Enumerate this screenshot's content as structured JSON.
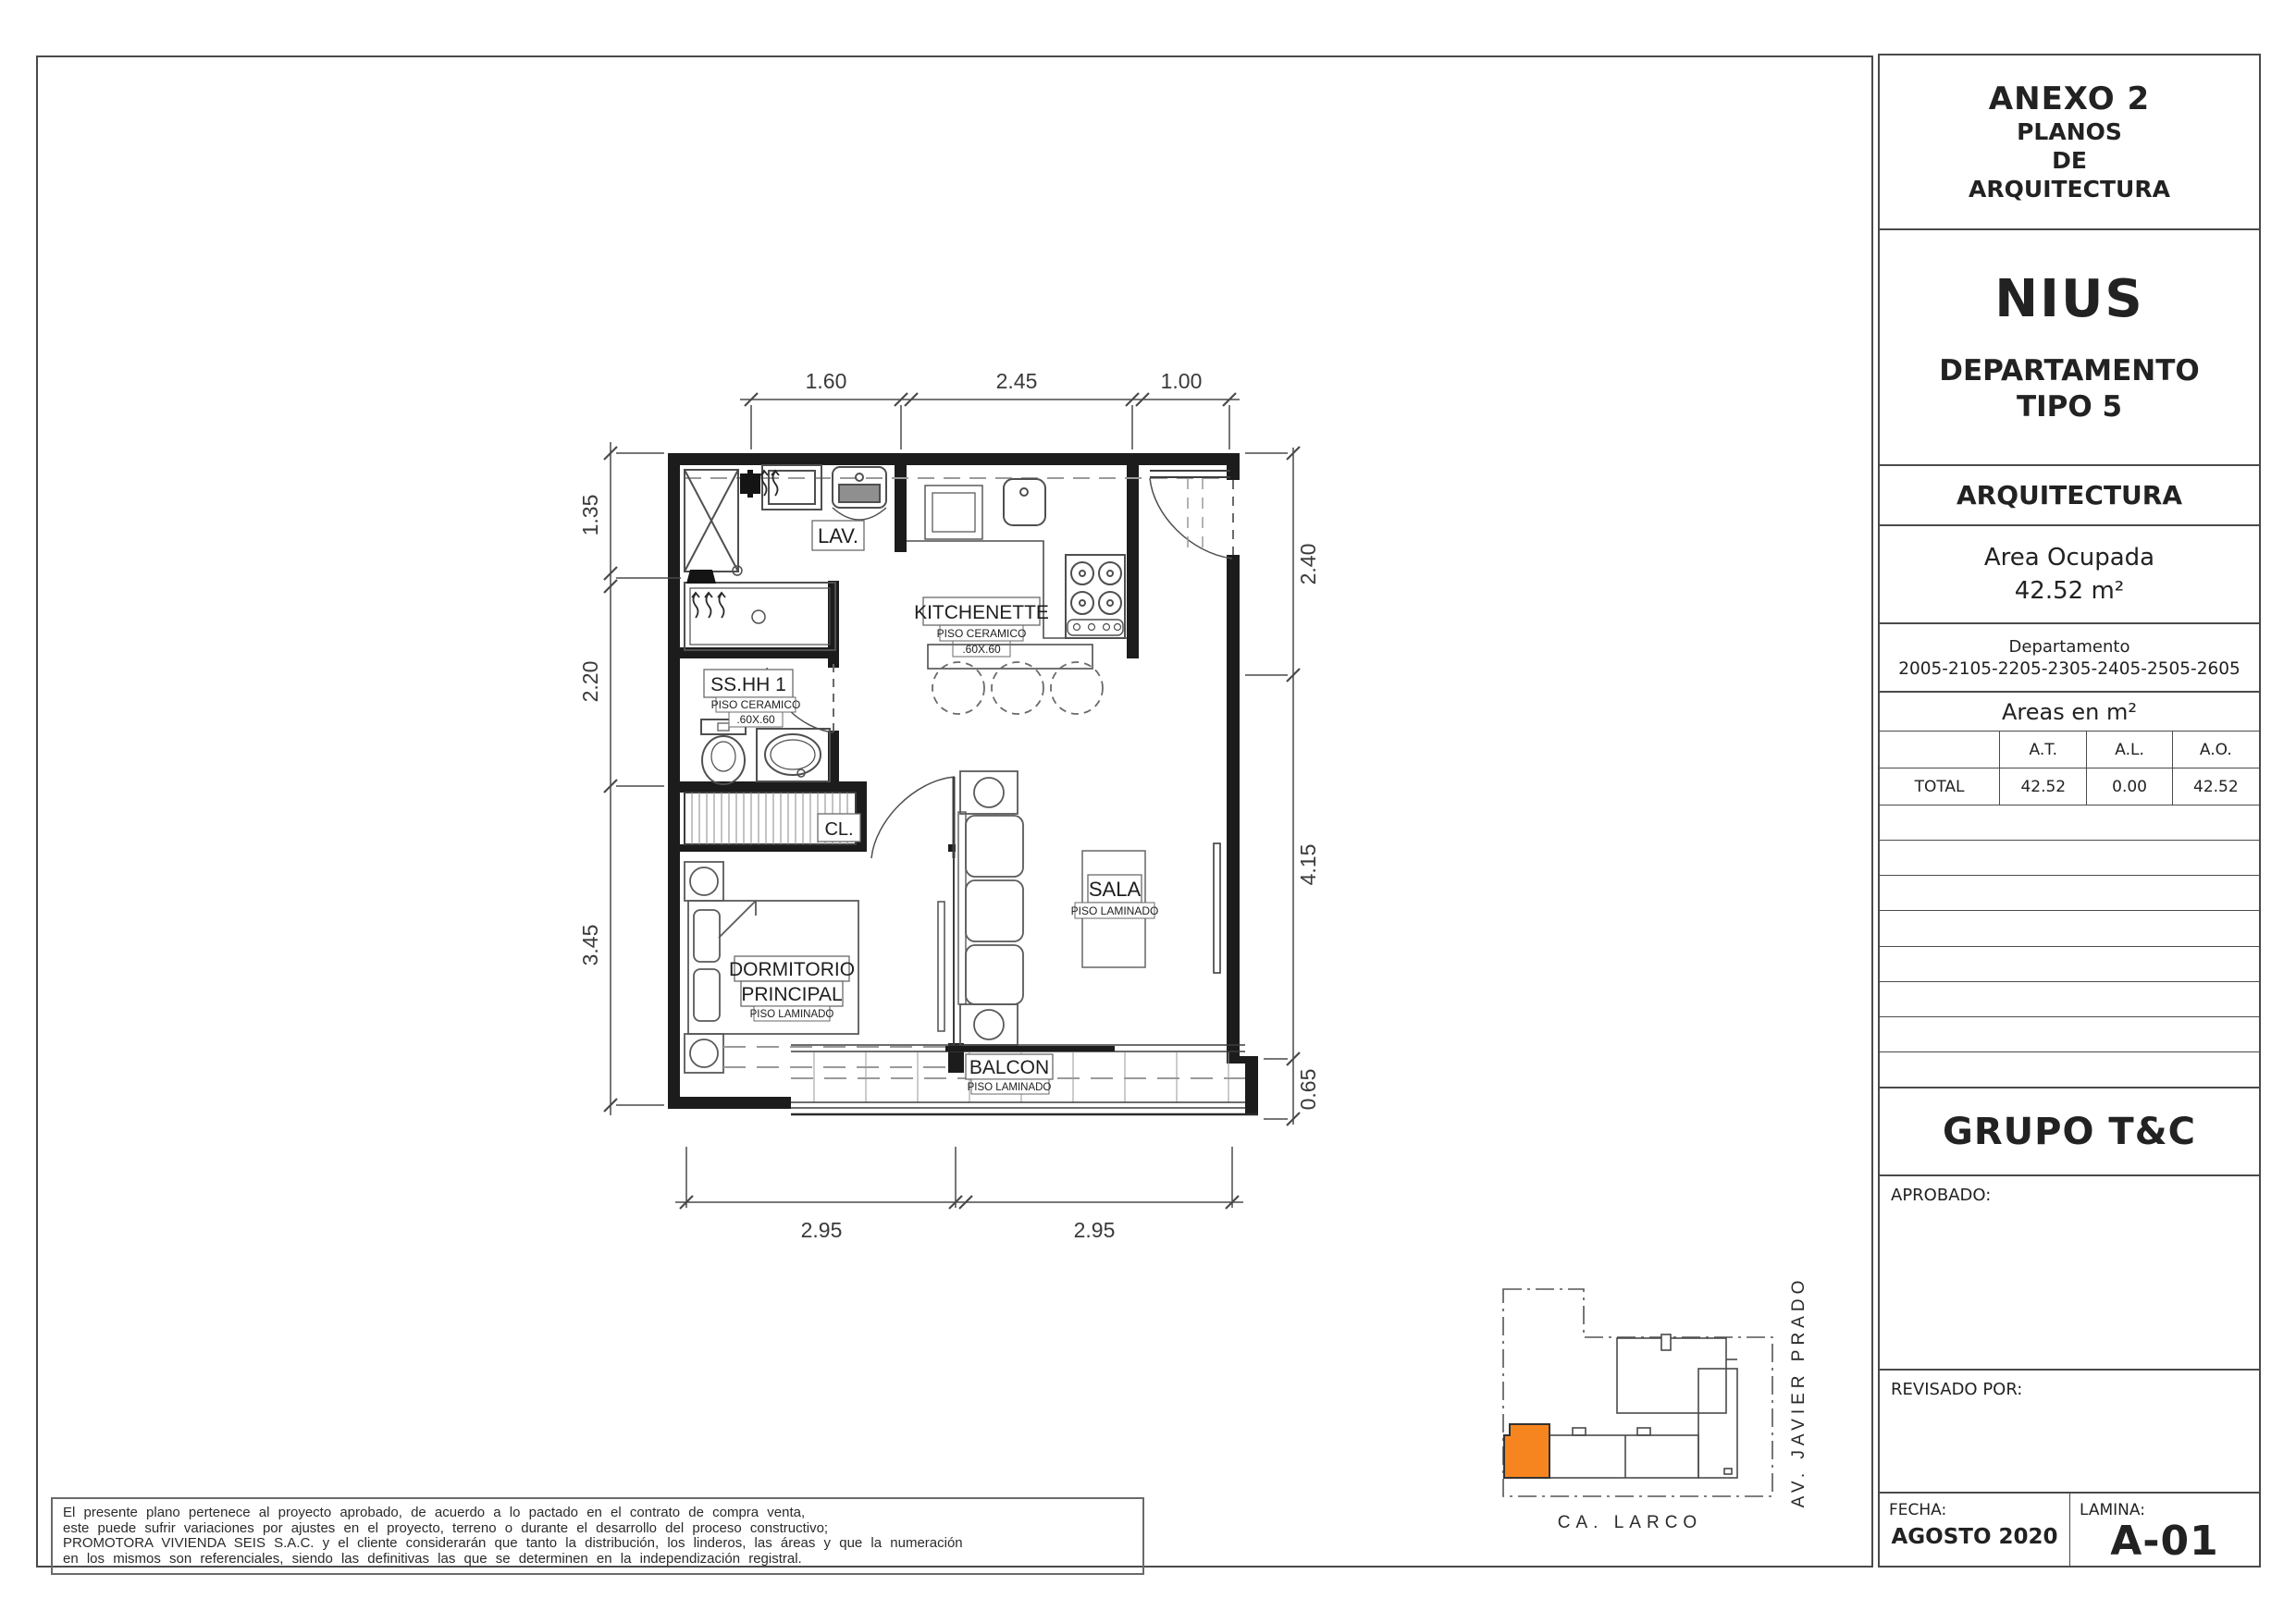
{
  "title_block": {
    "anexo_line1": "ANEXO 2",
    "anexo_line2": "PLANOS",
    "anexo_line3": "DE",
    "anexo_line4": "ARQUITECTURA",
    "project_name": "NIUS",
    "project_sub1": "DEPARTAMENTO",
    "project_sub2": "TIPO 5",
    "discipline": "ARQUITECTURA",
    "area_label": "Area Ocupada",
    "area_value": "42.52 m²",
    "dept_label": "Departamento",
    "dept_numbers": "2005-2105-2205-2305-2405-2505-2605",
    "areas_title": "Areas en m²",
    "table": {
      "h1": "A.T.",
      "h2": "A.L.",
      "h3": "A.O.",
      "row_label": "TOTAL",
      "v1": "42.52",
      "v2": "0.00",
      "v3": "42.52"
    },
    "company": "GRUPO T&C",
    "aprobado_label": "APROBADO:",
    "revisado_label": "REVISADO POR:",
    "fecha_label": "FECHA:",
    "fecha_value": "AGOSTO 2020",
    "lamina_label": "LAMINA:",
    "lamina_value": "A-01"
  },
  "disclaimer": {
    "line1": "El presente plano pertenece al proyecto aprobado, de acuerdo a lo pactado en el contrato de compra venta,",
    "line2": "este puede sufrir variaciones por ajustes en el proyecto, terreno o durante el desarrollo del proceso constructivo;",
    "line3": "PROMOTORA VIVIENDA SEIS S.A.C. y el cliente considerarán que tanto la distribución, los linderos, las áreas y que la numeración",
    "line4": "en los mismos son referenciales, siendo las definitivas las que se determinen en la independización registral."
  },
  "plan": {
    "rooms": {
      "lav": "LAV.",
      "kitchenette": "KITCHENETTE",
      "kitchenette_floor": "PISO  CERAMICO",
      "kitchenette_size": ".60X.60",
      "sshh": "SS.HH  1",
      "sshh_floor": "PISO  CERAMICO",
      "sshh_size": ".60X.60",
      "closet": "CL.",
      "dorm_line1": "DORMITORIO",
      "dorm_line2": "PRINCIPAL",
      "dorm_floor": "PISO  LAMINADO",
      "sala": "SALA",
      "sala_floor": "PISO  LAMINADO",
      "balcon": "BALCON",
      "balcon_floor": "PISO  LAMINADO"
    },
    "dims": {
      "top": [
        "1.60",
        "2.45",
        "1.00"
      ],
      "left": [
        "1.35",
        "2.20",
        "3.45"
      ],
      "right": [
        "2.40",
        "4.15",
        "0.65"
      ],
      "bottom": [
        "2.95",
        "2.95"
      ]
    }
  },
  "site_plan": {
    "street_bottom": "CA. LARCO",
    "street_right": "AV. JAVIER PRADO",
    "highlight_color": "#F6851F"
  }
}
